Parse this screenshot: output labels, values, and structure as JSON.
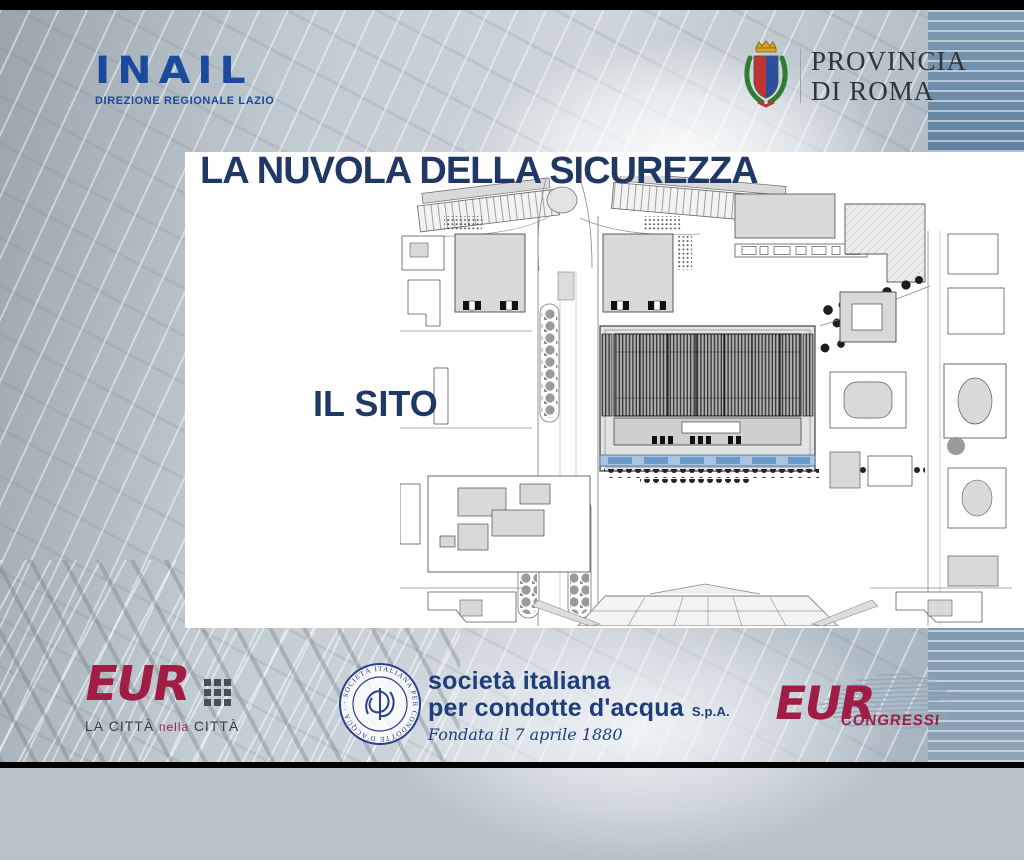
{
  "slide": {
    "title": "LA NUVOLA DELLA SICUREZZA",
    "section_label": "IL SITO"
  },
  "header": {
    "inail": {
      "logo": "INAIL",
      "subtitle": "DIREZIONE REGIONALE LAZIO"
    },
    "provincia": {
      "name_line1": "PROVINCIA",
      "name_line2": "DI ROMA"
    }
  },
  "footer": {
    "eur_city": {
      "logo": "EUR",
      "tagline": [
        "LA",
        "CITTÀ",
        "nella",
        "CITTÀ"
      ]
    },
    "condotte": {
      "seal_ring_text": "· SOCIETÀ ITALIANA PER CONDOTTE D'ACQUA · ROMA ·",
      "name_line1": "società italiana",
      "name_line2": "per condotte d'acqua",
      "name_suffix": "S.p.A.",
      "founded": "Fondata il 7 aprile 1880"
    },
    "eur_congressi": {
      "logo": "EUR",
      "label": "CONGRESSI"
    }
  },
  "map": {
    "description": "architectural site plan of the Nuvola convention centre area, EUR Rome"
  },
  "colors": {
    "title_navy": "#1f3864",
    "inail_blue": "#1a4a9b",
    "eur_maroon": "#a01d45",
    "condotte_navy": "#1e3d7a",
    "map_water_blue": "#a8c6e4"
  }
}
